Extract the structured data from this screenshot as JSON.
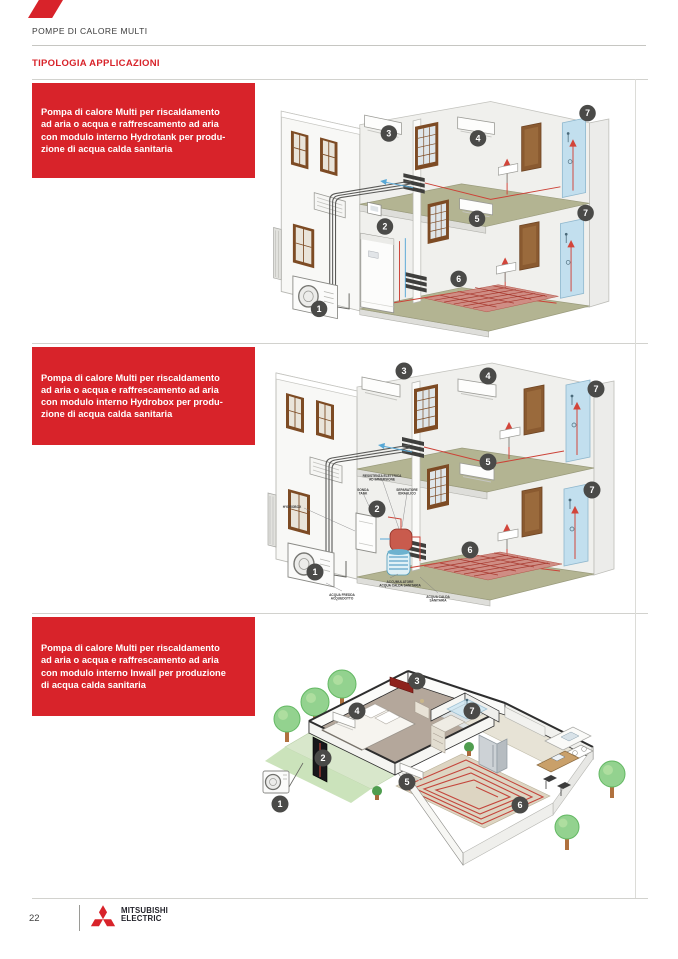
{
  "colors": {
    "accent_red": "#d8232a",
    "badge_fill": "#4a4a48",
    "floor_olive": "#b3b492",
    "shower_blue": "#c2dfee",
    "brand_text": "#23232b"
  },
  "header": {
    "eyebrow": "POMPE DI CALORE MULTI",
    "title": "TIPOLOGIA APPLICAZIONI"
  },
  "footer": {
    "page_number": "22",
    "brand_line1": "MITSUBISHI",
    "brand_line2": "ELECTRIC"
  },
  "sections": [
    {
      "name": "hydrotank",
      "description": "Pompa di calore Multi per riscaldamento\nad aria o acqua e raffrescamento ad aria\ncon modulo interno Hydrotank per produ-\nzione di acqua calda sanitaria",
      "badges": [
        {
          "n": "1",
          "x": 53,
          "y": 230
        },
        {
          "n": "2",
          "x": 121,
          "y": 145
        },
        {
          "n": "3",
          "x": 125,
          "y": 49
        },
        {
          "n": "4",
          "x": 217,
          "y": 54
        },
        {
          "n": "5",
          "x": 216,
          "y": 137
        },
        {
          "n": "6",
          "x": 197,
          "y": 199
        },
        {
          "n": "7",
          "x": 330,
          "y": 28
        },
        {
          "n": "7",
          "x": 328,
          "y": 131
        }
      ]
    },
    {
      "name": "hydrobox",
      "description": "Pompa di calore Multi per riscaldamento\nad aria o acqua e raffrescamento ad aria\ncon modulo interno Hydrobox per produ-\nzione di acqua calda sanitaria",
      "badges": [
        {
          "n": "1",
          "x": 53,
          "y": 225
        },
        {
          "n": "2",
          "x": 115,
          "y": 162
        },
        {
          "n": "3",
          "x": 142,
          "y": 24
        },
        {
          "n": "4",
          "x": 226,
          "y": 29
        },
        {
          "n": "5",
          "x": 226,
          "y": 115
        },
        {
          "n": "6",
          "x": 208,
          "y": 203
        },
        {
          "n": "7",
          "x": 334,
          "y": 42
        },
        {
          "n": "7",
          "x": 330,
          "y": 143
        }
      ],
      "labels": [
        {
          "text": "RESISTENZA ELETTRICA\nAD IMMERSIONE",
          "x": 120,
          "y": 130
        },
        {
          "text": "SONDA\nTANK",
          "x": 101,
          "y": 144
        },
        {
          "text": "SEPARATORE\nIDRAULICO",
          "x": 145,
          "y": 144
        },
        {
          "text": "HYDROBOX",
          "x": 30,
          "y": 161
        },
        {
          "text": "ACCUMULATORE\nACQUA CALDA SANITARIA",
          "x": 138,
          "y": 236
        },
        {
          "text": "ACQUA FREDDA\nACQUEDOTTO",
          "x": 80,
          "y": 249
        },
        {
          "text": "ACQUA CALDA\nSANITARIA",
          "x": 176,
          "y": 251
        }
      ]
    },
    {
      "name": "inwall",
      "description": "Pompa di calore Multi per riscaldamento\nad aria o acqua e raffrescamento ad aria\ncon modulo interno Inwall per produzione\ndi acqua calda sanitaria",
      "badges": [
        {
          "n": "1",
          "x": 25,
          "y": 163
        },
        {
          "n": "2",
          "x": 68,
          "y": 117
        },
        {
          "n": "3",
          "x": 162,
          "y": 40
        },
        {
          "n": "4",
          "x": 102,
          "y": 70
        },
        {
          "n": "5",
          "x": 152,
          "y": 141
        },
        {
          "n": "6",
          "x": 265,
          "y": 164
        },
        {
          "n": "7",
          "x": 217,
          "y": 70
        }
      ]
    }
  ]
}
